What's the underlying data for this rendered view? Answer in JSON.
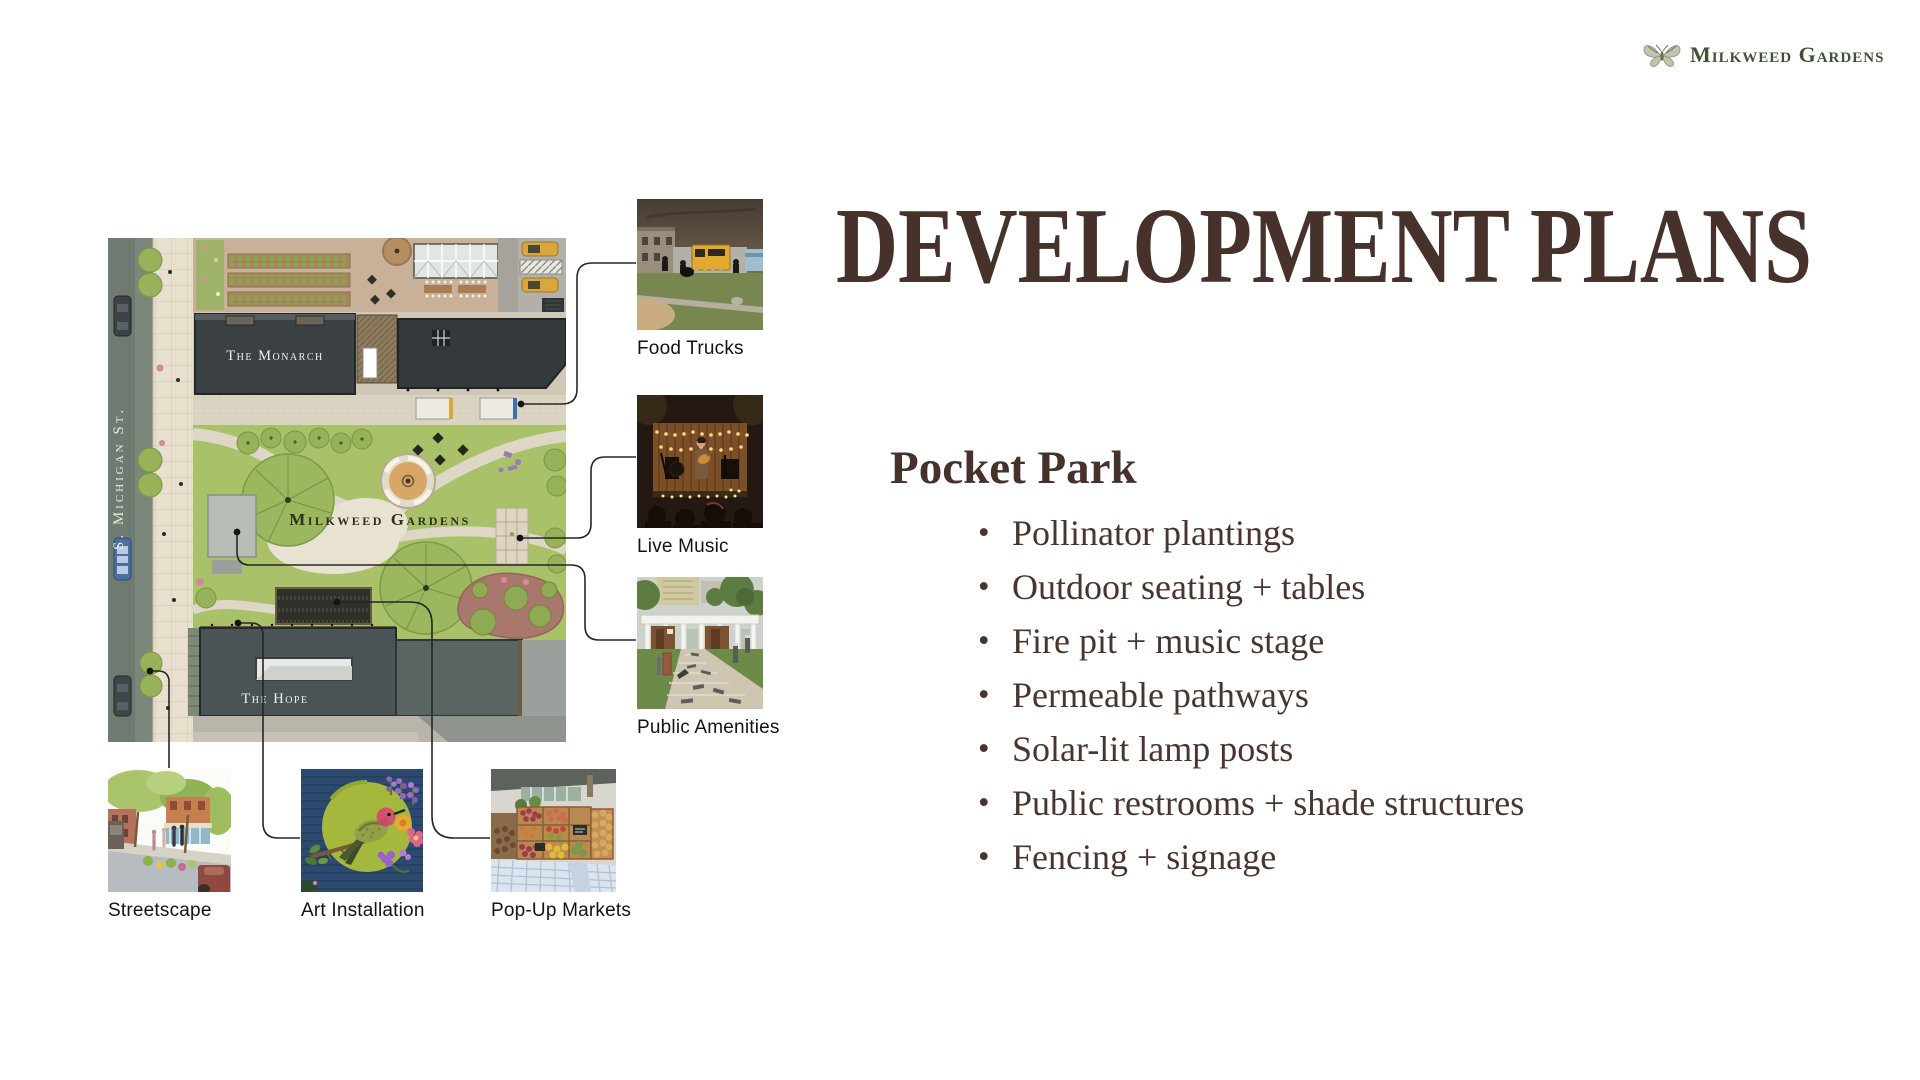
{
  "logo": {
    "name": "Milkweed Gardens",
    "icon": "butterfly-icon"
  },
  "title": "DEVELOPMENT PLANS",
  "section": {
    "heading": "Pocket Park",
    "bullets": [
      "Pollinator plantings",
      "Outdoor seating + tables",
      "Fire pit + music stage",
      "Permeable pathways",
      "Solar-lit lamp posts",
      "Public restrooms + shade structures",
      "Fencing + signage"
    ]
  },
  "site_plan": {
    "street_label": "S. Michigan St.",
    "park_label": "Milkweed Gardens",
    "building_labels": {
      "monarch": "The Monarch",
      "hope": "The Hope"
    }
  },
  "callouts": [
    {
      "label": "Food Trucks"
    },
    {
      "label": "Live Music"
    },
    {
      "label": "Public Amenities"
    },
    {
      "label": "Streetscape"
    },
    {
      "label": "Art Installation"
    },
    {
      "label": "Pop-Up Markets"
    }
  ],
  "colors": {
    "text_brown": "#46322b",
    "logo_green": "#3f5233",
    "lawn_green": "#a9c169",
    "building_charcoal": "#3b4043",
    "hope_slate": "#4a5355",
    "street_gray": "#6f7b70",
    "paver_tan": "#e8e0ce",
    "fire_pit_tan": "#d8a767",
    "mulch_red": "#a9776b"
  }
}
